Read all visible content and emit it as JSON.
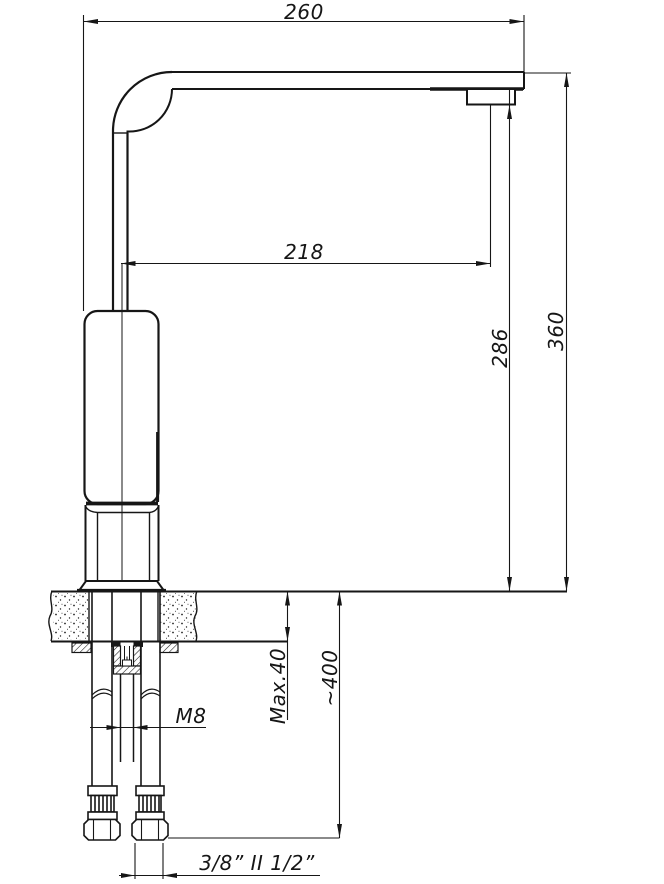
{
  "drawing": {
    "title": "kitchen-faucet-installation-drawing",
    "colors": {
      "line": "#161616",
      "background": "#ffffff"
    },
    "dimensions": {
      "spout_reach_overall": "260",
      "spout_reach_to_aerator": "218",
      "aerator_to_deck_height": "286",
      "overall_height": "360",
      "deck_thickness": "Max.40",
      "hose_length": "~400",
      "mounting_stud_thread": "M8",
      "hose_connector_sizes": "3/8” II 1/2”"
    }
  }
}
